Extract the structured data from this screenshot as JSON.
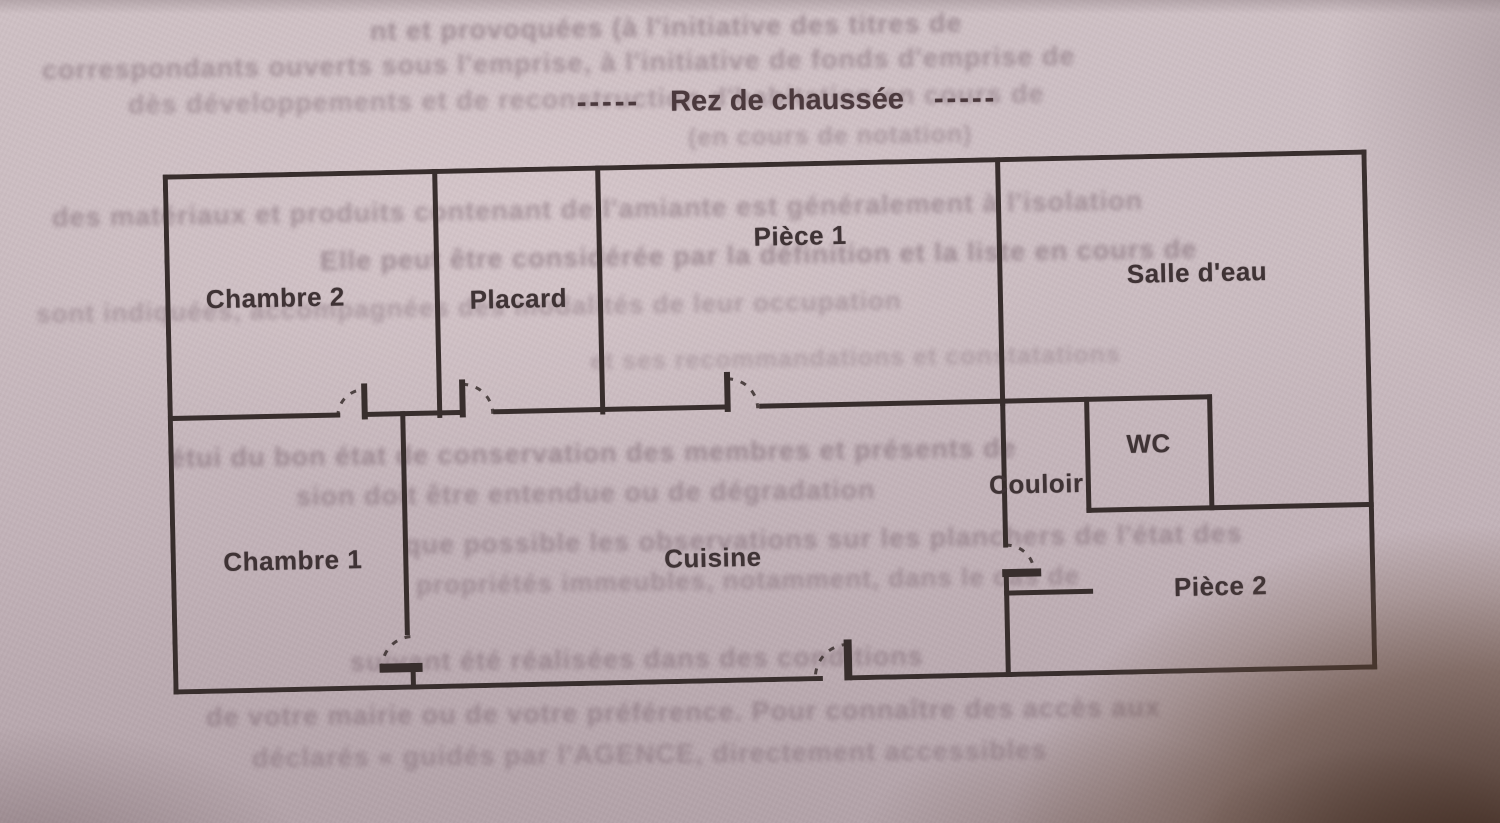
{
  "document": {
    "title": "Rez de chaussée",
    "title_dashes_left": "-----",
    "title_dashes_right": "-----"
  },
  "floor_plan": {
    "rooms": [
      {
        "name": "Chambre 2"
      },
      {
        "name": "Placard"
      },
      {
        "name": "Pièce 1"
      },
      {
        "name": "Salle d'eau"
      },
      {
        "name": "WC"
      },
      {
        "name": "Couloir"
      },
      {
        "name": "Chambre 1"
      },
      {
        "name": "Cuisine"
      },
      {
        "name": "Pièce 2"
      }
    ]
  },
  "colors": {
    "ink": "#382e2d",
    "paper": "#c8b9bf",
    "corner_shadow": "#3a251a"
  },
  "ghost_text": {
    "note": "illegible bleed-through from reverse side of page",
    "lines": [
      {
        "text": "nt et provoquées (à l'initiative des titres de"
      },
      {
        "text": "correspondants ouverts sous l'emprise, à l'initiative de fonds d'emprise de"
      },
      {
        "text": "dès développements et de reconstruction d'habitation en cours de"
      },
      {
        "text": "(en cours de notation)"
      },
      {
        "text": "des matériaux et produits contenant de l'amiante est généralement à l'isolation"
      },
      {
        "text": "Elle peut être considérée par la définition et la liste en cours de"
      },
      {
        "text": "sont indiquées, accompagnées des modalités de leur occupation"
      },
      {
        "text": "et ses recommandations et constatations"
      },
      {
        "text": "étui du bon état de conservation des membres et présents de"
      },
      {
        "text": "sion doit être entendue ou de dégradation"
      },
      {
        "text": "que possible les observations sur les planchers de l'état des"
      },
      {
        "text": "propriétés immeubles, notamment, dans le cas de"
      },
      {
        "text": "suivant été réalisées dans des conditions"
      },
      {
        "text": "de votre mairie ou de votre préférence. Pour connaître des accès aux"
      },
      {
        "text": "déclarés « guidés par l'AGENCE, directement accessibles"
      }
    ]
  }
}
